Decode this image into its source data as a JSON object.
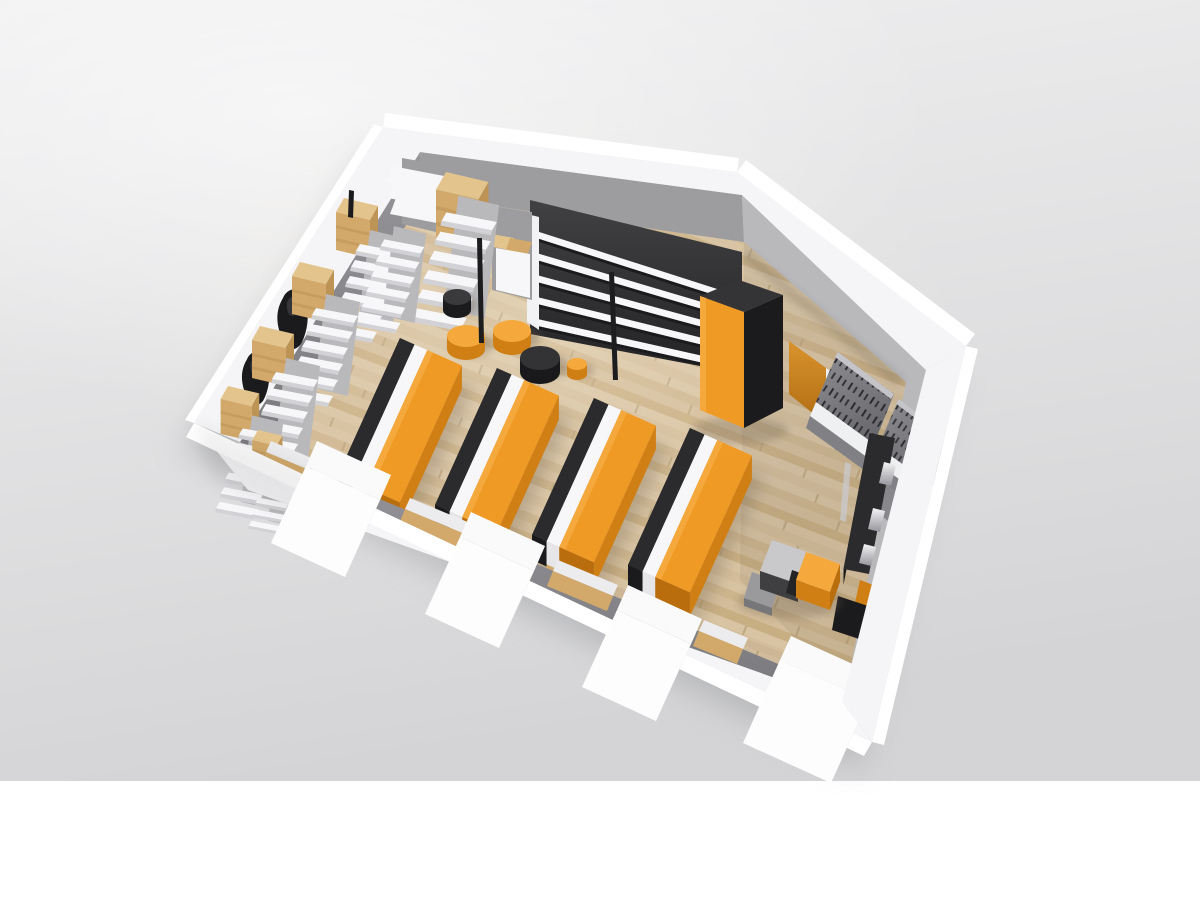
{
  "scene": {
    "title": "3D isometric render of a retail store floor plan",
    "description": "Cutaway architectural visualization: white walls with window piers, light wood floor, orange display tables, white shelving gondolas, round poufs and a checkout counter"
  },
  "palette": {
    "bg-top": "#f0f0f1",
    "bg-bottom": "#d4d4d6",
    "bg-glow": "#fafafa",
    "canvas": "#ffffff",
    "shadow": "#a6a6aa",
    "wall-top": "#f5f5f7",
    "wall-outer": "#ffffff",
    "wall-edge": "#e4e4e7",
    "gray-wall": "#9d9da0",
    "gray-wall-dark": "#7e7e82",
    "gray-wall-light": "#b9b9bc",
    "dark-wall": "#343437",
    "charcoal": "#2b2b2d",
    "charcoal-deep": "#1b1b1d",
    "floor-a": "#d8c3a2",
    "floor-b": "#cdb58e",
    "floor-c": "#d3bd9a",
    "floor-d": "#c8ae83",
    "floor-seam": "#b49b73",
    "orange": "#f09a26",
    "orange-light": "#f5a93c",
    "orange-dark": "#d07f15",
    "orange-deep": "#b96d0d",
    "tan": "#d2a96a",
    "tan-light": "#e3c48d",
    "tan-dark": "#bd9456",
    "shelf": "#f7f7f9",
    "shelf-shadow": "#d2d2d6",
    "chrome": "#c9c9ce",
    "blob": "#1b1b1d"
  },
  "objects": {
    "display_tables": {
      "count": 4,
      "label": "orange display tables flanked by charcoal and white benches"
    },
    "feature_wall_shelves": {
      "count": 5,
      "label": "white shelf boards on charcoal feature wall"
    },
    "side_gondolas": {
      "count": 6,
      "label": "white stepped gondola shelving with oak caps along left wall"
    },
    "poufs": {
      "orange_large": 2,
      "charcoal_large": 1,
      "charcoal_small": 1,
      "orange_small": 1,
      "label": "round poufs"
    },
    "lamp_poles": {
      "count": 2,
      "label": "black floor lamp poles"
    },
    "wardrobe_cabinet": {
      "count": 1,
      "label": "tall charcoal cabinet with orange front"
    },
    "rear_door": {
      "count": 1,
      "label": "orange door in rear wall"
    },
    "card_racks": {
      "count": 2,
      "label": "grey leaning merchandise racks"
    },
    "checkout_counter": {
      "count": 1,
      "label": "charcoal checkout counter with chrome displays"
    },
    "cash_desk": {
      "count": 1,
      "label": "grey cash desk with orange cube"
    },
    "window_piers": {
      "count": 4,
      "label": "white window piers on front wall"
    },
    "window_sills": {
      "count": 4,
      "label": "oak window sills"
    },
    "mannequins": {
      "count": 3,
      "label": "dark hanging-clothes silhouettes"
    }
  }
}
